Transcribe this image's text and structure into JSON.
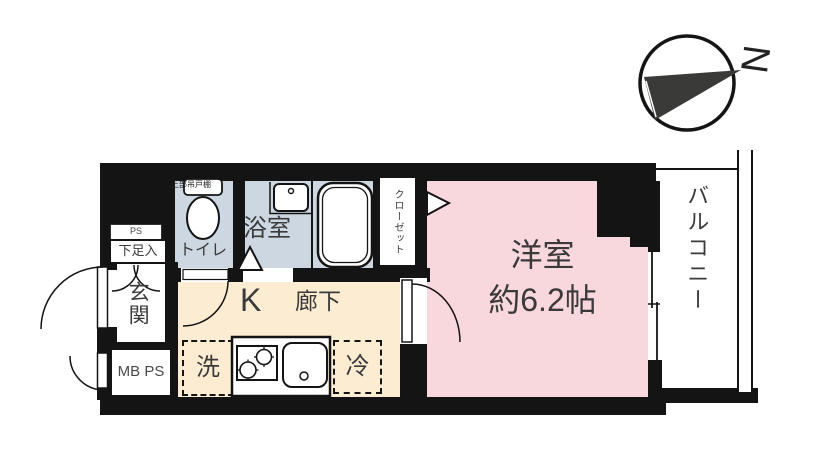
{
  "compass": {
    "north": "N"
  },
  "labels": {
    "balcony": "バルコニー",
    "room_name": "洋室",
    "room_size": "約6.2帖",
    "closet": "クローゼット",
    "bath": "浴室",
    "toilet": "トイレ",
    "upper_cabinet": "上部吊戸棚",
    "corridor": "廊下",
    "kitchen": "K",
    "entrance": "玄関",
    "shoe_cabinet": "下足入",
    "pipe_space": "PS",
    "meter_box": "MB PS",
    "washer": "洗",
    "fridge": "冷"
  },
  "colors": {
    "wall": "#141414",
    "room_pink": "#f8d7dd",
    "hall_cream": "#fcecd2",
    "wet_blue": "#ccd7e2",
    "text": "#3a3a3a"
  }
}
